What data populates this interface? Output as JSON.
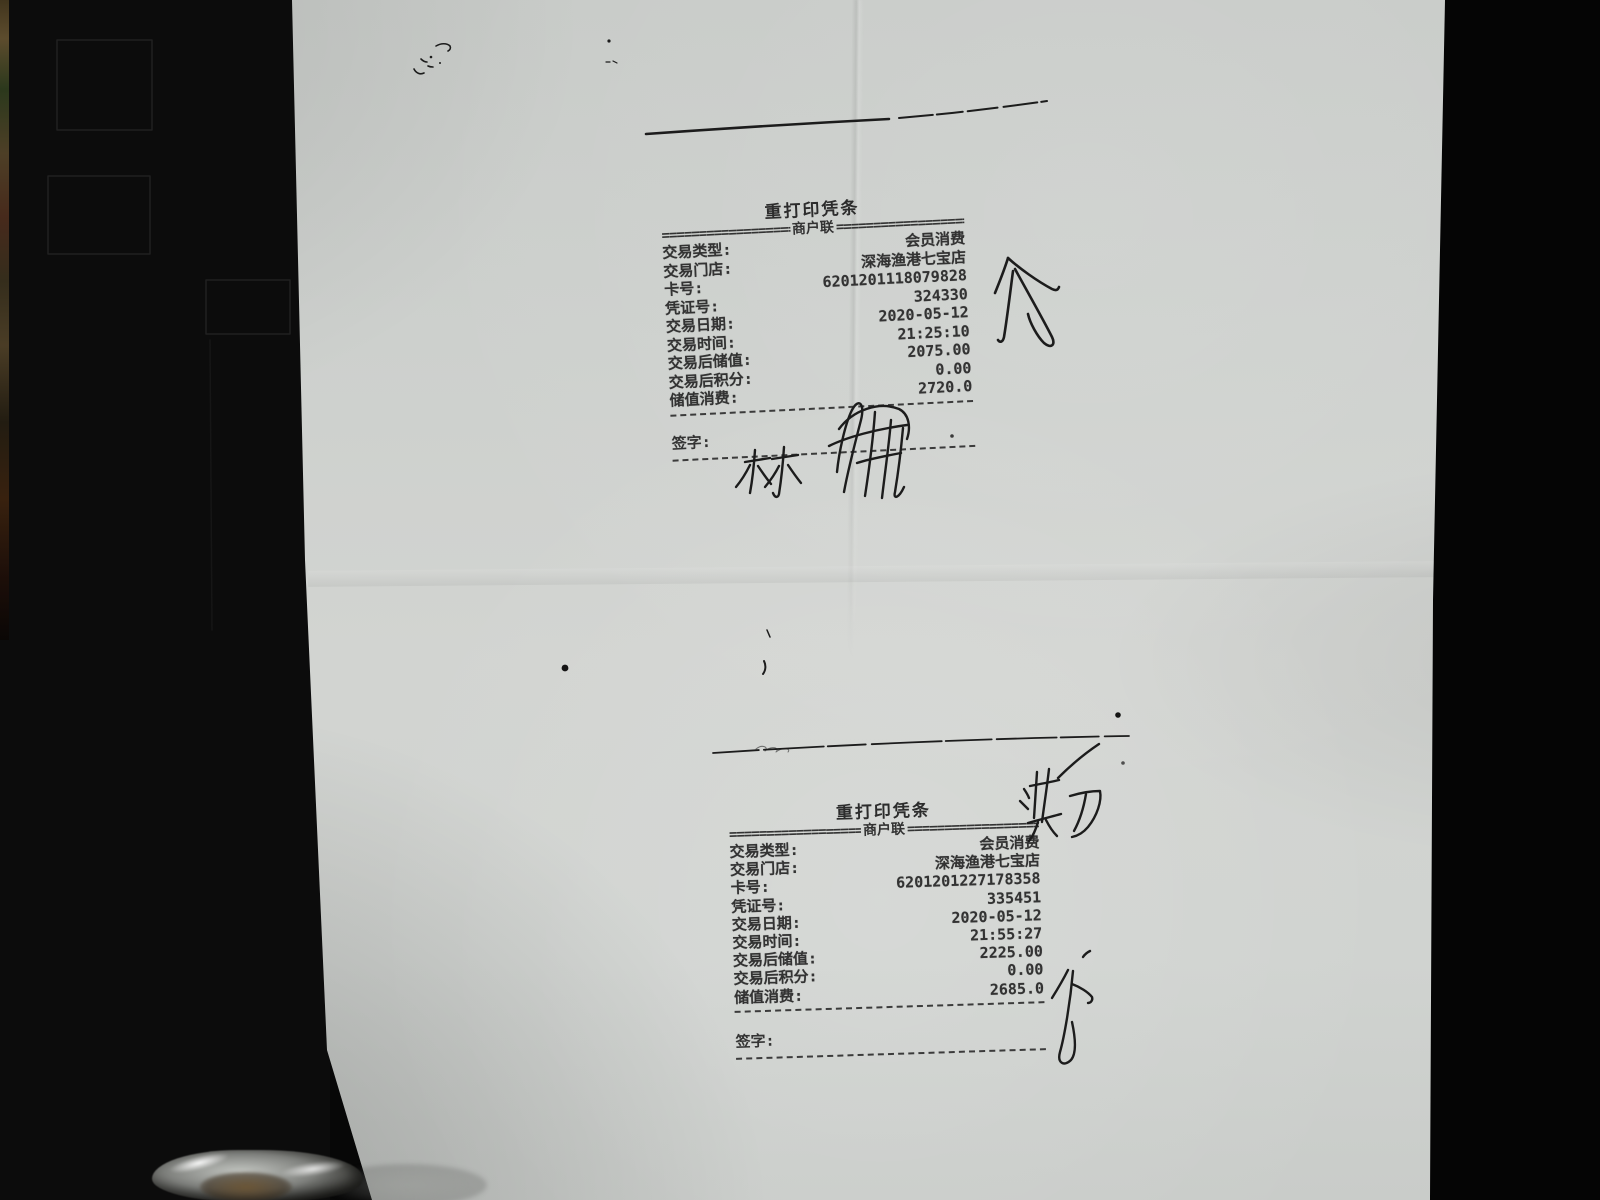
{
  "colors": {
    "background": "#070707",
    "paper": "#ced1ce",
    "print_ink": "#333333",
    "pen_ink": "#1c1c1c"
  },
  "receipt1": {
    "title": "重打印凭条",
    "copy_left": "====================",
    "copy_center": "商户联",
    "copy_right": "====================",
    "rows": [
      {
        "label": "交易类型:",
        "value": "会员消费"
      },
      {
        "label": "交易门店:",
        "value": "深海渔港七宝店"
      },
      {
        "label": "卡号:",
        "value": "6201201118079828"
      },
      {
        "label": "凭证号:",
        "value": "324330"
      },
      {
        "label": "交易日期:",
        "value": "2020-05-12"
      },
      {
        "label": "交易时间:",
        "value": "21:25:10"
      },
      {
        "label": "交易后储值:",
        "value": "2075.00"
      },
      {
        "label": "交易后积分:",
        "value": "0.00"
      },
      {
        "label": "储值消费:",
        "value": "2720.0"
      }
    ],
    "sign_label": "签字:",
    "handwritten_signature": "林 + illegible scribble",
    "handwritten_side_mark": "介"
  },
  "receipt2": {
    "title": "重打印凭条",
    "copy_left": "====================",
    "copy_center": "商户联",
    "copy_right": "====================",
    "rows": [
      {
        "label": "交易类型:",
        "value": "会员消费"
      },
      {
        "label": "交易门店:",
        "value": "深海渔港七宝店"
      },
      {
        "label": "卡号:",
        "value": "6201201227178358"
      },
      {
        "label": "凭证号:",
        "value": "335451"
      },
      {
        "label": "交易日期:",
        "value": "2020-05-12"
      },
      {
        "label": "交易时间:",
        "value": "21:55:27"
      },
      {
        "label": "交易后储值:",
        "value": "2225.00"
      },
      {
        "label": "交易后积分:",
        "value": "0.00"
      },
      {
        "label": "储值消费:",
        "value": "2685.0"
      }
    ],
    "sign_label": "签字:",
    "handwritten_top_mark": "洪刀",
    "handwritten_side_mark": "分"
  }
}
